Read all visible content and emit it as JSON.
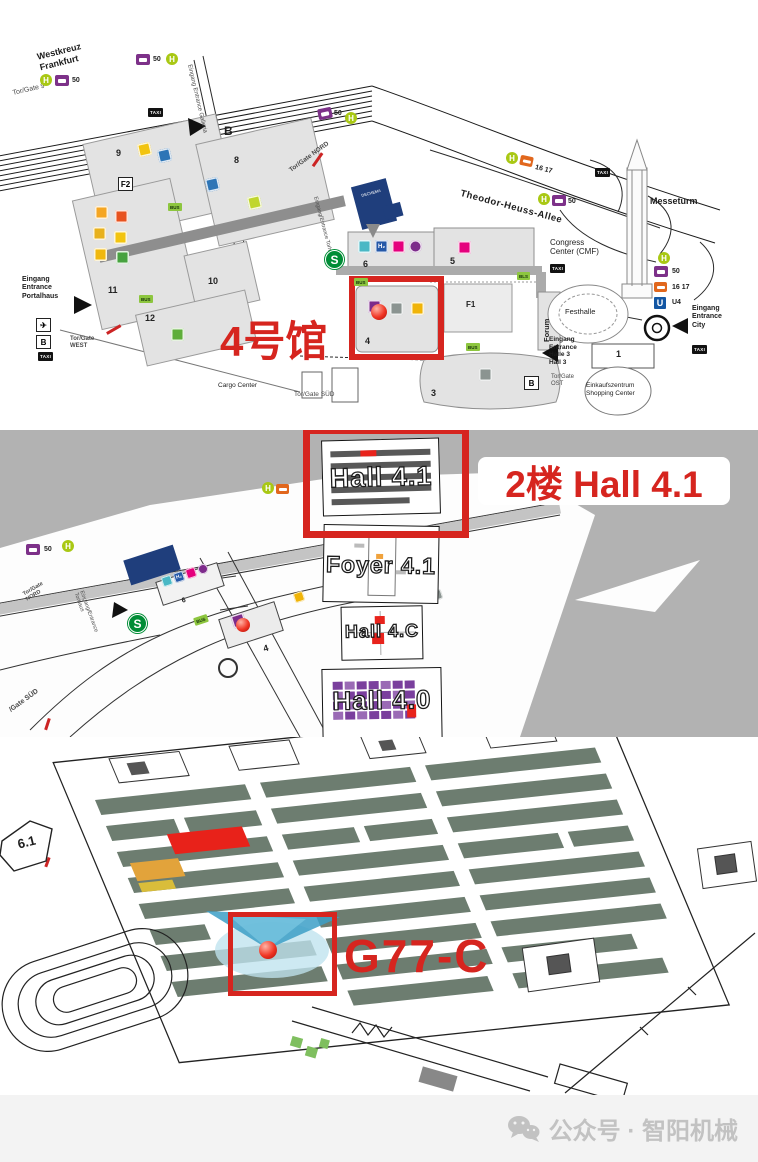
{
  "overview": {
    "highlight_label": "4号馆",
    "halls": {
      "h9": "9",
      "h8": "8",
      "f2": "F2",
      "h11": "11",
      "h10": "10",
      "h12": "12",
      "h6": "6",
      "h5": "5",
      "h4": "4",
      "h3": "3",
      "f1": "F1",
      "h1": "1",
      "forum": "Forum"
    },
    "labels": {
      "westkreuz": "Westkreuz\nFrankfurt",
      "tor_gate_9": "Tor/Gate 9",
      "galleria": "Eingang Entrance Galleria",
      "torhaus": "Eingang/Entrance Torhaus",
      "tor_gate_nord": "Tor/Gate NORD",
      "theodor_heuss_allee": "Theodor-Heuss-Allee",
      "messeturm": "Messeturm",
      "congress_center": "Congress\nCenter (CMF)",
      "dechema": "DECHEMA",
      "festhalle": "Festhalle",
      "eingang_city": "Eingang\nEntrance\nCity",
      "shopping_center": "Einkaufszentrum\nShopping Center",
      "eingang_halle3": "Eingang\nEntrance\nHalle 3\nHall 3",
      "tor_gate_ost": "Tor/Gate\nOST",
      "eingang_portalhaus": "Eingang\nEntrance\nPortalhaus",
      "tor_gate_west": "Tor/Gate\nWEST",
      "cargo_center": "Cargo Center",
      "tor_gate_sued": "Tor/Gate SÜD"
    },
    "transit": {
      "h": "H",
      "s": "S",
      "u": "U",
      "line_50": "50",
      "line_16_17": "16 17",
      "line_u4": "U4",
      "taxi": "TAXI",
      "bus": "BUS",
      "bls": "BLS",
      "h2": "H₂",
      "b": "B",
      "plane": "✈"
    }
  },
  "levels": {
    "highlight_label": "2楼 Hall 4.1",
    "cards": {
      "hall_41": "Hall 4.1",
      "foyer_41": "Foyer 4.1",
      "hall_4c": "Hall 4.C",
      "hall_40": "Hall 4.0"
    },
    "labels": {
      "tor_gate_nord": "Tor/Gate\nNORD",
      "torhaus": "Eingang/Entrance\nTorhaus",
      "gate_sued": "/Gate SÜD",
      "hall_4": "4",
      "hall_6": "6",
      "line_50": "50",
      "h2": "H₂",
      "s": "S",
      "h": "H"
    }
  },
  "floor": {
    "area_label": "6.1",
    "booth_label": "G77-C"
  },
  "watermark": {
    "label": "公众号 · 智阳机械"
  }
}
